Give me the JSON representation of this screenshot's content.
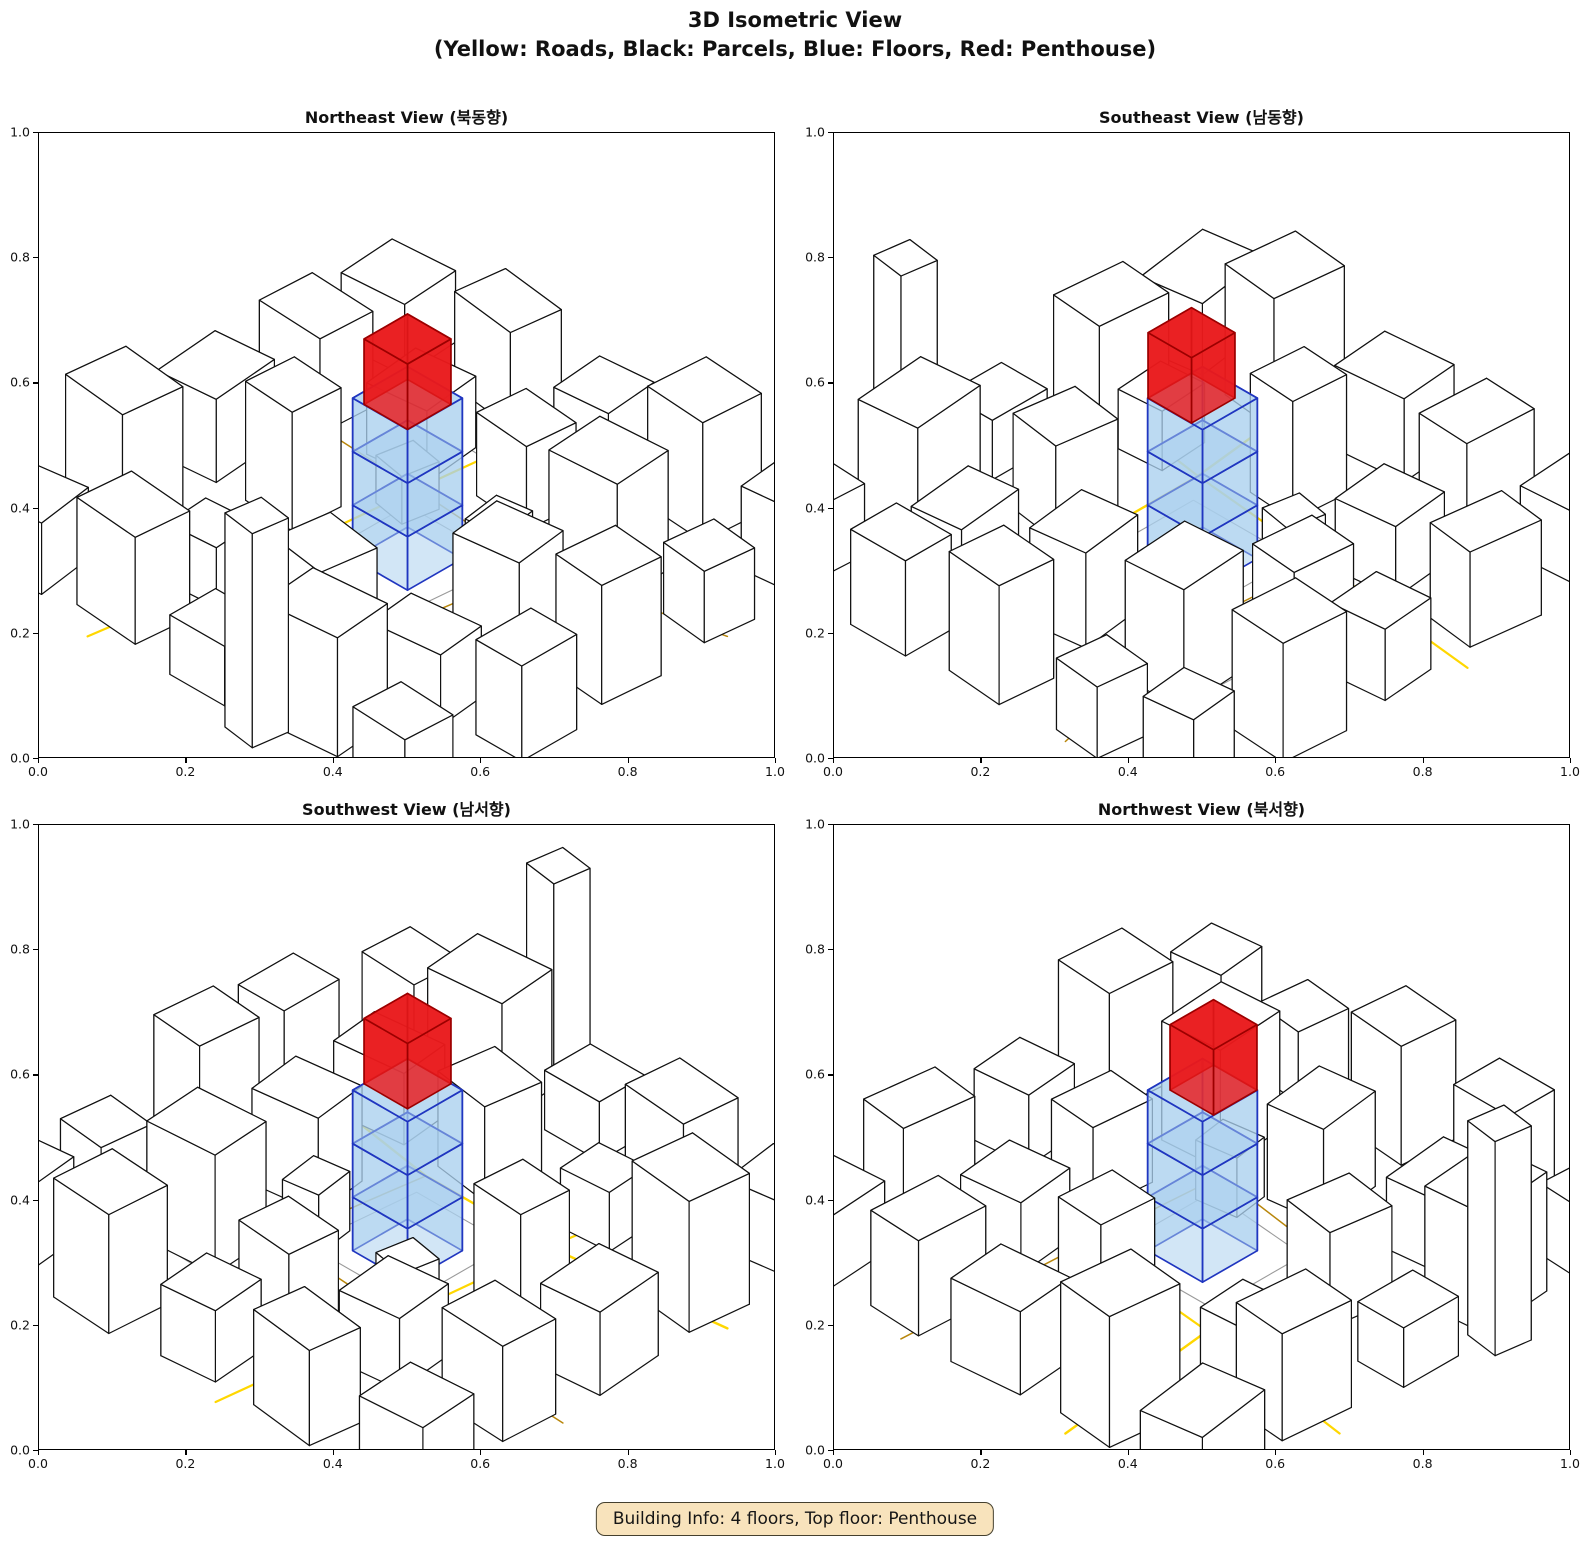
{
  "figure": {
    "title_line1": "3D Isometric View",
    "title_line2": "(Yellow: Roads, Black: Parcels, Blue: Floors, Red: Penthouse)"
  },
  "info_box": {
    "label": "Building Info: 4 floors, Top floor: Penthouse",
    "bg": "#f8e3bc",
    "border": "#45402e"
  },
  "axis": {
    "ticks": [
      "0.0",
      "0.2",
      "0.4",
      "0.6",
      "0.8",
      "1.0"
    ],
    "range": [
      0.0,
      1.0
    ]
  },
  "colors": {
    "road_bright": "#FFD700",
    "road_dark": "#B8860B",
    "parcel_edge": "#111111",
    "building_fill": "#ffffff",
    "floor_fill": "rgba(168,207,238,0.52)",
    "floor_edge": "#2036c0",
    "penthouse_fill": "rgba(233,26,28,0.82)",
    "penthouse_edge": "#9c0000",
    "ground_line": "#9a9a9a"
  },
  "subplots": [
    {
      "id": "ne",
      "title": "Northeast View (북동향)",
      "azimuth": 0
    },
    {
      "id": "se",
      "title": "Southeast View (남동향)",
      "azimuth": 90
    },
    {
      "id": "sw",
      "title": "Southwest View (남서향)",
      "azimuth": 180
    },
    {
      "id": "nw",
      "title": "Northwest View (북서향)",
      "azimuth": 270
    }
  ],
  "scene": {
    "buildings": [
      [
        0.08,
        0.92,
        0.16,
        0.12,
        0.06,
        -8
      ],
      [
        0.3,
        0.9,
        0.14,
        0.11,
        0.09,
        5
      ],
      [
        0.52,
        0.93,
        0.12,
        0.1,
        0.05,
        0
      ],
      [
        0.72,
        0.9,
        0.15,
        0.12,
        0.1,
        -5
      ],
      [
        0.92,
        0.93,
        0.12,
        0.1,
        0.06,
        3
      ],
      [
        0.66,
        0.99,
        0.07,
        0.07,
        0.18,
        8
      ],
      [
        0.1,
        0.72,
        0.14,
        0.12,
        0.11,
        6
      ],
      [
        0.33,
        0.76,
        0.1,
        0.09,
        0.05,
        -4
      ],
      [
        0.56,
        0.74,
        0.12,
        0.11,
        0.08,
        8
      ],
      [
        0.78,
        0.74,
        0.14,
        0.1,
        0.06,
        -6
      ],
      [
        0.96,
        0.7,
        0.1,
        0.12,
        0.08,
        0
      ],
      [
        0.08,
        0.5,
        0.12,
        0.14,
        0.07,
        -5
      ],
      [
        0.27,
        0.52,
        0.11,
        0.1,
        0.1,
        4
      ],
      [
        0.74,
        0.52,
        0.13,
        0.11,
        0.08,
        -7
      ],
      [
        0.94,
        0.5,
        0.11,
        0.12,
        0.1,
        5
      ],
      [
        0.1,
        0.3,
        0.14,
        0.11,
        0.08,
        3
      ],
      [
        0.31,
        0.28,
        0.12,
        0.12,
        0.06,
        -6
      ],
      [
        0.52,
        0.26,
        0.12,
        0.1,
        0.07,
        5
      ],
      [
        0.74,
        0.3,
        0.14,
        0.12,
        0.1,
        -4
      ],
      [
        0.94,
        0.28,
        0.1,
        0.1,
        0.06,
        6
      ],
      [
        0.08,
        0.1,
        0.13,
        0.12,
        0.06,
        -4
      ],
      [
        0.3,
        0.08,
        0.14,
        0.1,
        0.08,
        7
      ],
      [
        0.52,
        0.09,
        0.11,
        0.11,
        0.06,
        -5
      ],
      [
        0.73,
        0.08,
        0.13,
        0.12,
        0.1,
        4
      ],
      [
        0.93,
        0.1,
        0.1,
        0.1,
        0.07,
        -6
      ],
      [
        0.4,
        0.4,
        0.07,
        0.07,
        0.04,
        10
      ],
      [
        0.63,
        0.43,
        0.07,
        0.08,
        0.05,
        -8
      ]
    ],
    "roads": [
      {
        "kind": "bright",
        "width": 2.4,
        "pts": [
          [
            0.0,
            0.7
          ],
          [
            0.35,
            0.66
          ],
          [
            0.62,
            0.66
          ],
          [
            1.0,
            0.72
          ]
        ]
      },
      {
        "kind": "bright",
        "width": 2.2,
        "pts": [
          [
            0.3,
            1.0
          ],
          [
            0.35,
            0.66
          ],
          [
            0.38,
            0.36
          ],
          [
            0.42,
            0.0
          ]
        ]
      },
      {
        "kind": "dark",
        "width": 1.5,
        "pts": [
          [
            0.0,
            0.34
          ],
          [
            0.38,
            0.36
          ],
          [
            0.66,
            0.38
          ],
          [
            1.0,
            0.3
          ]
        ]
      },
      {
        "kind": "dark",
        "width": 1.5,
        "pts": [
          [
            0.62,
            0.66
          ],
          [
            0.66,
            0.38
          ]
        ]
      }
    ],
    "ground_lines": [
      [
        [
          0.4,
          0.62
        ],
        [
          0.6,
          0.62
        ],
        [
          0.62,
          0.4
        ],
        [
          0.4,
          0.4
        ],
        [
          0.4,
          0.62
        ]
      ],
      [
        [
          0.24,
          0.22
        ],
        [
          0.76,
          0.24
        ]
      ]
    ],
    "subject": {
      "cx": 0.5,
      "cy": 0.5,
      "w": 0.12,
      "d": 0.12,
      "blue_floors": 3,
      "floor_h": 0.045,
      "penthouse": {
        "w": 0.095,
        "d": 0.095,
        "h": 0.055,
        "dx": 0.012,
        "dy": 0.012
      }
    }
  },
  "chart_data": {
    "type": "table",
    "title": "3D Isometric View (Yellow: Roads, Black: Parcels, Blue: Floors, Red: Penthouse)",
    "subplot_titles": [
      "Northeast View (북동향)",
      "Southeast View (남동향)",
      "Southwest View (남서향)",
      "Northwest View (북서향)"
    ],
    "xlim": [
      0.0,
      1.0
    ],
    "ylim": [
      0.0,
      1.0
    ],
    "xticks": [
      0.0,
      0.2,
      0.4,
      0.6,
      0.8,
      1.0
    ],
    "yticks": [
      0.0,
      0.2,
      0.4,
      0.6,
      0.8,
      1.0
    ],
    "legend": {
      "Yellow": "Roads",
      "Black": "Parcels",
      "Blue": "Floors",
      "Red": "Penthouse"
    },
    "building_info": {
      "total_floors": 4,
      "blue_floor_boxes": 3,
      "top_floor": "Penthouse"
    }
  }
}
